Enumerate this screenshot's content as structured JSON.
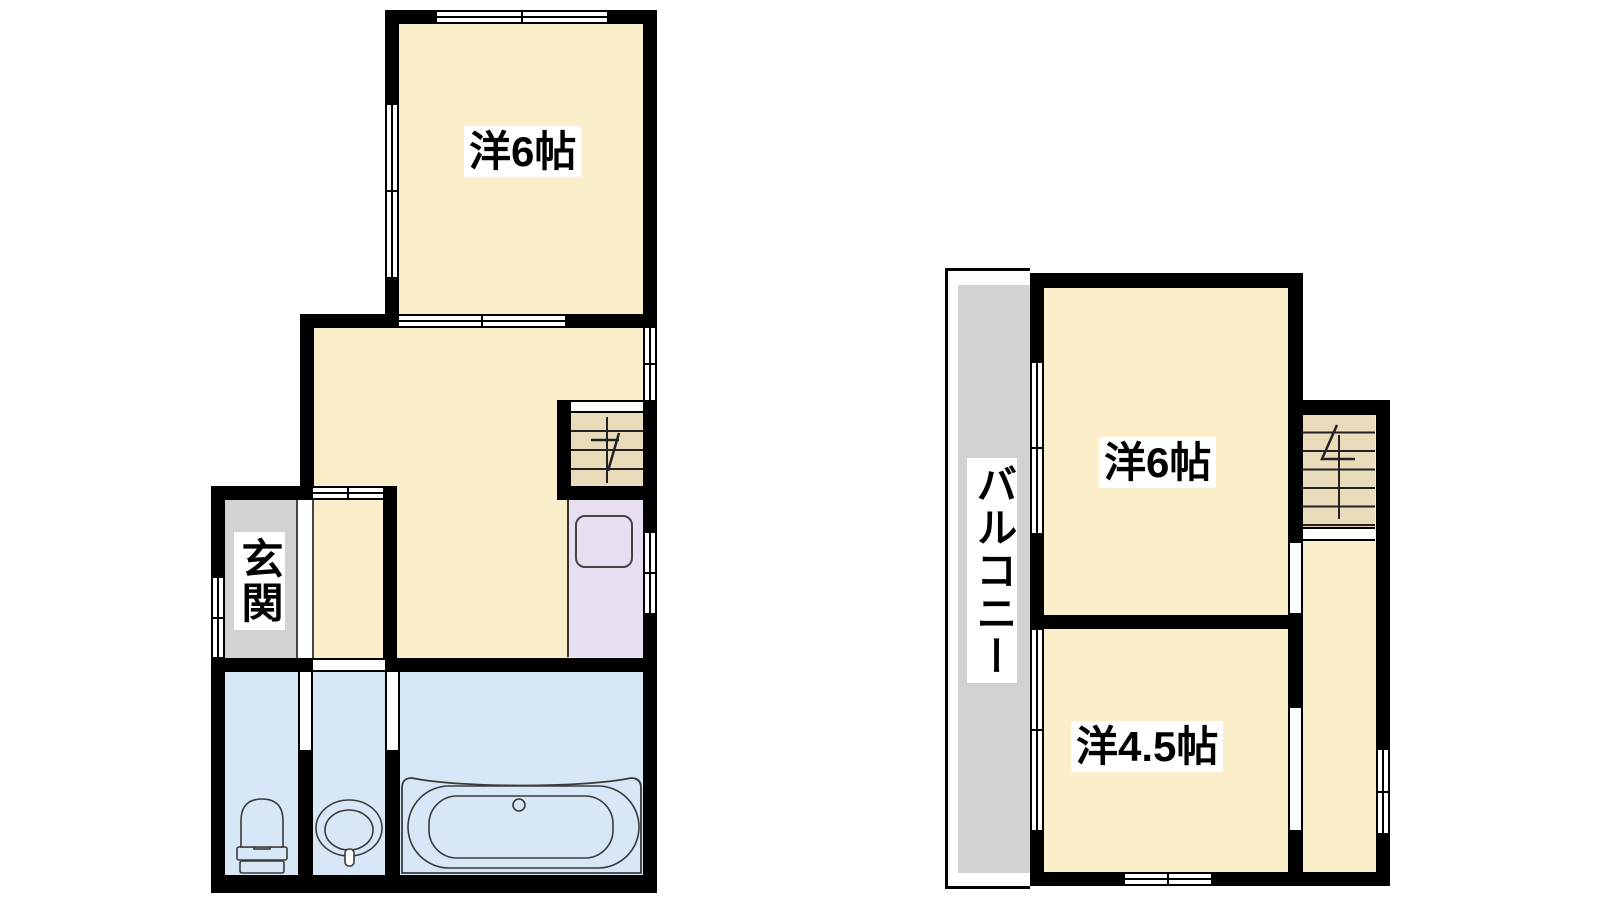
{
  "floor1": {
    "western_room_label": "洋6帖",
    "entrance_label": "玄関"
  },
  "floor2": {
    "western_room_label": "洋6帖",
    "western_room_45_label": "洋4.5帖",
    "balcony_label": "バルコニー"
  },
  "colors": {
    "room_cream": "#fbeecb",
    "wet_blue": "#d8e7f8",
    "kitchen_lavender": "#e8def1",
    "stairs_tan": "#eadcbb",
    "gray_area": "#d2d2d2",
    "wall_black": "#000000",
    "label_bg": "#ffffff",
    "fixture_line": "#3a3a3a"
  },
  "icons": [
    "toilet-icon",
    "washbasin-icon",
    "bathtub-icon",
    "kitchen-sink-icon",
    "stairs-down-arrow-icon",
    "stairs-up-arrow-icon",
    "window-symbol",
    "door-opening-symbol"
  ]
}
